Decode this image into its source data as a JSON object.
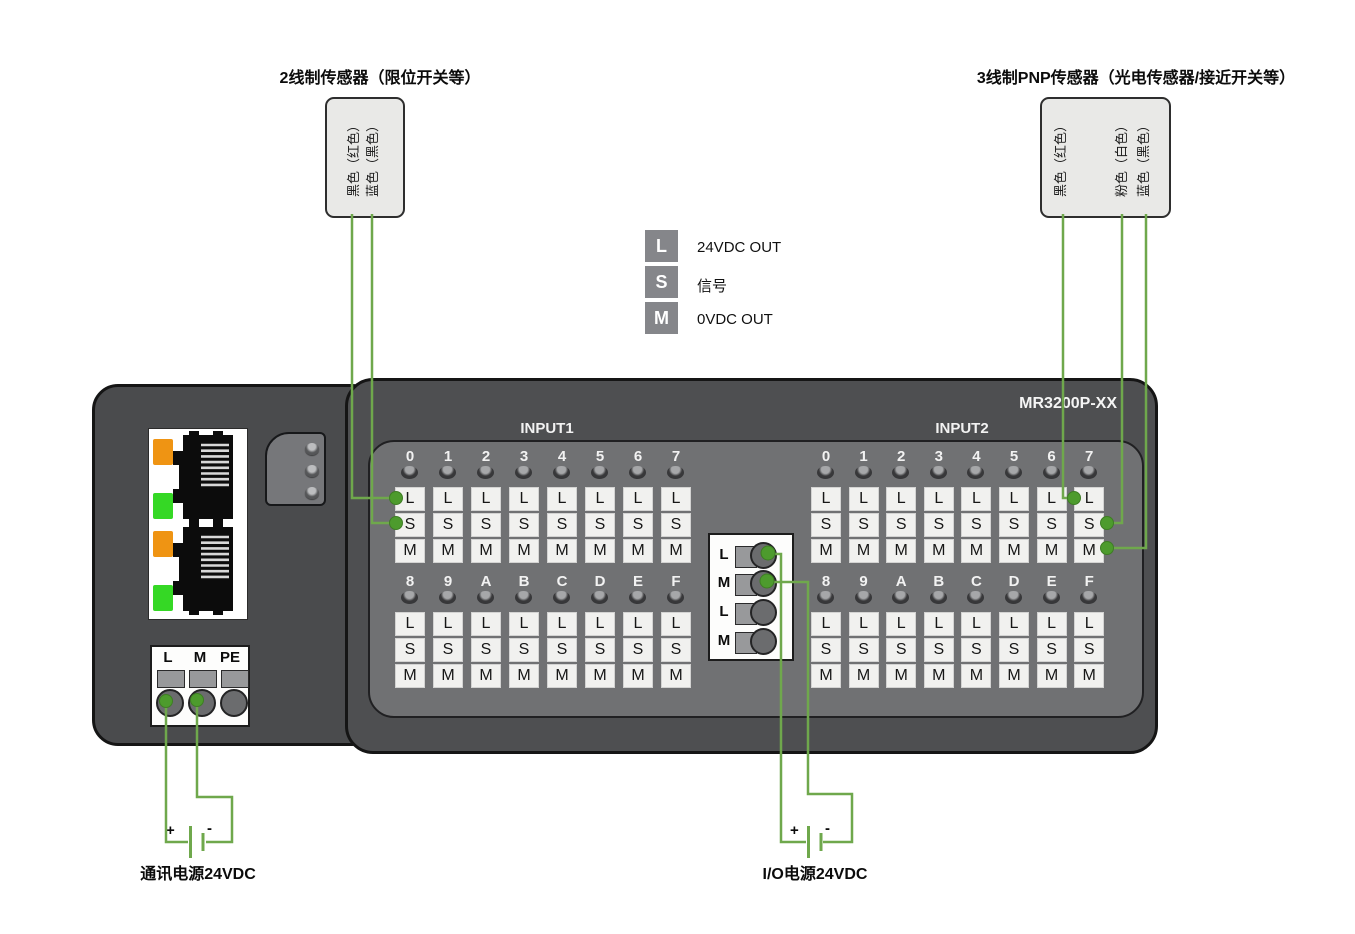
{
  "sensors": {
    "two_wire": {
      "title": "2线制传感器（限位开关等）",
      "wires": [
        "黑色（红色）",
        "蓝色（黑色）"
      ]
    },
    "three_wire": {
      "title": "3线制PNP传感器（光电传感器/接近开关等）",
      "wires": [
        "黑色（红色）",
        "粉色（白色）",
        "蓝色（黑色）"
      ]
    }
  },
  "legend": {
    "items": [
      {
        "key": "L",
        "desc": "24VDC OUT"
      },
      {
        "key": "S",
        "desc": "信号"
      },
      {
        "key": "M",
        "desc": "0VDC OUT"
      }
    ]
  },
  "module": {
    "model": "MR3200P-XX",
    "input1_label": "INPUT1",
    "input2_label": "INPUT2",
    "channel_rows": {
      "row1": [
        "0",
        "1",
        "2",
        "3",
        "4",
        "5",
        "6",
        "7"
      ],
      "row2": [
        "8",
        "9",
        "A",
        "B",
        "C",
        "D",
        "E",
        "F"
      ]
    },
    "cell_labels": [
      "L",
      "S",
      "M"
    ],
    "center_block_labels": [
      "L",
      "M",
      "L",
      "M"
    ],
    "power_terminal_labels": [
      "L",
      "M",
      "PE"
    ]
  },
  "power": {
    "comm": {
      "label": "通讯电源24VDC",
      "plus": "+",
      "minus": "-"
    },
    "io": {
      "label": "I/O电源24VDC",
      "plus": "+",
      "minus": "-"
    }
  },
  "colors": {
    "wire": "#6FA84C",
    "wire_dot": "#4D9B2D",
    "led_orange": "#EF9413",
    "led_green": "#35D825",
    "module_body": "#4E4F51",
    "inner_panel": "#707173",
    "terminal_cell": "#F1F1EF",
    "legend_square": "#85868A"
  }
}
